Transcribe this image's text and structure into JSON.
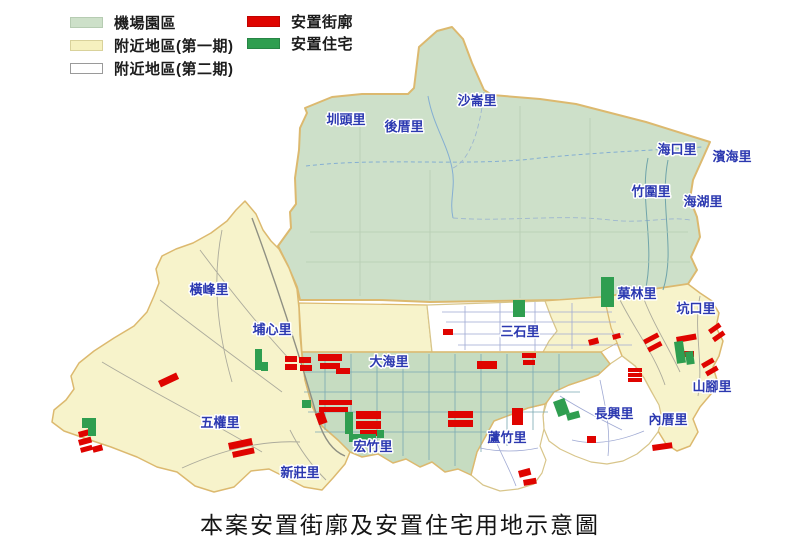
{
  "title": "本案安置街廓及安置住宅用地示意圖",
  "legend": {
    "items": [
      {
        "label": "機場園區",
        "color": "#cde0c9",
        "border": "#b6ccb2",
        "x": 70,
        "y": 12
      },
      {
        "label": "附近地區(第一期)",
        "color": "#f6f1bf",
        "border": "#d9d29b",
        "x": 70,
        "y": 35
      },
      {
        "label": "附近地區(第二期)",
        "color": "#ffffff",
        "border": "#9a9a9a",
        "x": 70,
        "y": 58
      },
      {
        "label": "安置街廓",
        "color": "#df0400",
        "border": "#c00300",
        "x": 247,
        "y": 11
      },
      {
        "label": "安置住宅",
        "color": "#2f9e50",
        "border": "#278545",
        "x": 247,
        "y": 33
      }
    ]
  },
  "map": {
    "colors": {
      "airport_fill": "#cde0c9",
      "nearby1_fill": "#f7f3cb",
      "nearby2_fill": "#ffffff",
      "dahai_fill": "#c6dcc1",
      "block_red": "#df0400",
      "block_green": "#2f9e50",
      "boundary": "#dcb96f",
      "boundary_light": "#d8c58a",
      "label_blue": "#2b38b0"
    },
    "villages": [
      {
        "name": "沙崙里",
        "x": 477,
        "y": 105
      },
      {
        "name": "圳頭里",
        "x": 346,
        "y": 124
      },
      {
        "name": "後厝里",
        "x": 404,
        "y": 131
      },
      {
        "name": "海口里",
        "x": 677,
        "y": 154
      },
      {
        "name": "濱海里",
        "x": 732,
        "y": 161
      },
      {
        "name": "竹圍里",
        "x": 651,
        "y": 196
      },
      {
        "name": "海湖里",
        "x": 703,
        "y": 206
      },
      {
        "name": "橫峰里",
        "x": 209,
        "y": 294
      },
      {
        "name": "埔心里",
        "x": 272,
        "y": 334
      },
      {
        "name": "三石里",
        "x": 520,
        "y": 336
      },
      {
        "name": "菓林里",
        "x": 637,
        "y": 298
      },
      {
        "name": "坑口里",
        "x": 696,
        "y": 313
      },
      {
        "name": "大海里",
        "x": 389,
        "y": 366
      },
      {
        "name": "山腳里",
        "x": 712,
        "y": 391
      },
      {
        "name": "長興里",
        "x": 614,
        "y": 418
      },
      {
        "name": "內厝里",
        "x": 668,
        "y": 424
      },
      {
        "name": "蘆竹里",
        "x": 507,
        "y": 442
      },
      {
        "name": "五權里",
        "x": 220,
        "y": 427
      },
      {
        "name": "宏竹里",
        "x": 373,
        "y": 451
      },
      {
        "name": "新莊里",
        "x": 300,
        "y": 477
      }
    ],
    "red_blocks": [
      [
        285,
        356,
        12,
        6
      ],
      [
        285,
        364,
        12,
        6
      ],
      [
        299,
        357,
        12,
        6
      ],
      [
        300,
        365,
        12,
        6
      ],
      [
        318,
        354,
        24,
        7
      ],
      [
        320,
        363,
        20,
        6
      ],
      [
        336,
        368,
        14,
        6
      ],
      [
        477,
        361,
        20,
        8
      ],
      [
        443,
        329,
        10,
        6
      ],
      [
        522,
        353,
        14,
        5
      ],
      [
        523,
        360,
        12,
        5
      ],
      [
        588,
        340,
        10,
        6,
        -15
      ],
      [
        612,
        335,
        8,
        5,
        -15
      ],
      [
        628,
        368,
        14,
        4
      ],
      [
        628,
        373,
        14,
        4
      ],
      [
        628,
        378,
        14,
        4
      ],
      [
        643,
        340,
        16,
        5,
        -28
      ],
      [
        647,
        348,
        15,
        5,
        -28
      ],
      [
        676,
        337,
        20,
        6,
        -10
      ],
      [
        684,
        351,
        10,
        6
      ],
      [
        708,
        330,
        13,
        5,
        -35
      ],
      [
        712,
        338,
        13,
        5,
        -35
      ],
      [
        701,
        364,
        13,
        5,
        -30
      ],
      [
        705,
        372,
        13,
        5,
        -30
      ],
      [
        319,
        400,
        33,
        5
      ],
      [
        319,
        407,
        29,
        5
      ],
      [
        315,
        414,
        9,
        12,
        -20
      ],
      [
        356,
        411,
        25,
        8
      ],
      [
        356,
        421,
        25,
        8
      ],
      [
        360,
        430,
        18,
        6
      ],
      [
        448,
        411,
        25,
        7
      ],
      [
        448,
        420,
        25,
        7
      ],
      [
        512,
        408,
        11,
        17
      ],
      [
        587,
        436,
        9,
        7
      ],
      [
        652,
        445,
        20,
        6,
        -8
      ],
      [
        518,
        471,
        12,
        7,
        -15
      ],
      [
        523,
        480,
        13,
        6,
        -10
      ],
      [
        158,
        381,
        20,
        7,
        -25
      ],
      [
        78,
        432,
        13,
        6,
        -15
      ],
      [
        78,
        440,
        13,
        6,
        -15
      ],
      [
        80,
        448,
        12,
        5,
        -15
      ],
      [
        92,
        447,
        10,
        6,
        -15
      ],
      [
        228,
        443,
        24,
        7,
        -12
      ],
      [
        232,
        452,
        22,
        6,
        -12
      ]
    ],
    "green_blocks": [
      [
        255,
        349,
        7,
        21
      ],
      [
        261,
        362,
        7,
        9
      ],
      [
        302,
        400,
        9,
        8
      ],
      [
        345,
        412,
        8,
        22
      ],
      [
        349,
        434,
        27,
        8
      ],
      [
        377,
        430,
        7,
        8
      ],
      [
        674,
        342,
        9,
        22,
        -8
      ],
      [
        685,
        352,
        8,
        13,
        -8
      ],
      [
        553,
        402,
        12,
        16,
        -20
      ],
      [
        566,
        414,
        13,
        7,
        -15
      ],
      [
        82,
        418,
        14,
        10
      ],
      [
        88,
        428,
        8,
        8
      ],
      [
        513,
        300,
        12,
        17
      ],
      [
        601,
        277,
        13,
        30
      ]
    ]
  }
}
